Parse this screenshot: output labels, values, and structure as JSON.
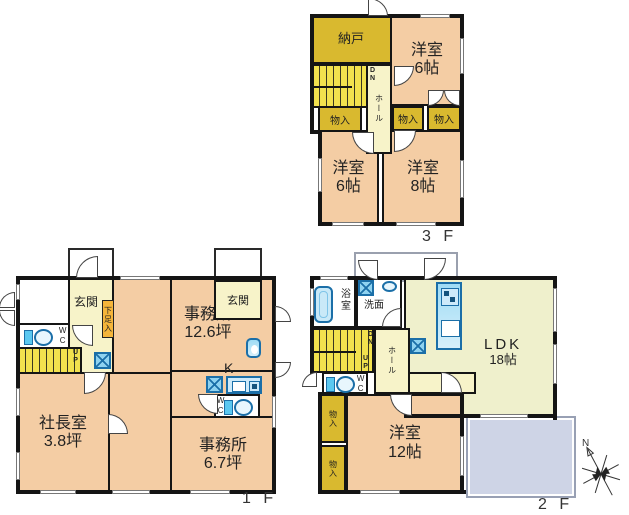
{
  "colors": {
    "wall": "#151515",
    "room_peach": "#f4cda4",
    "closet_dark_yellow": "#d9b92f",
    "stairs_yellow": "#f2e14e",
    "hall_pale_yellow": "#f7f3c9",
    "ldk_pale": "#eff0cc",
    "fixture_blue": "#1b6fa8",
    "fixture_blue_light": "#8ed2f0",
    "shoe_cabinet_orange": "#f5b53a",
    "balcony_gray_blue": "#ced4e6"
  },
  "f3": {
    "floor_label": "3 F",
    "nando": "納戸",
    "room_top_name": "洋室",
    "room_top_size": "6帖",
    "closets": [
      "物入",
      "物入",
      "物入"
    ],
    "room_left_name": "洋室",
    "room_left_size": "6帖",
    "room_right_name": "洋室",
    "room_right_size": "8帖",
    "hall": "ホール",
    "dn": "DN"
  },
  "f1": {
    "floor_label": "1 F",
    "entrance_left": "玄関",
    "entrance_right": "玄関",
    "shoe_cabinet": "下足入",
    "wc_left": "WC",
    "wc_right": "WC",
    "up": "UP",
    "office_large_name": "事務所",
    "office_large_size": "12.6坪",
    "kitchen": "K",
    "president_name": "社長室",
    "president_size": "3.8坪",
    "office_small_name": "事務所",
    "office_small_size": "6.7坪"
  },
  "f2": {
    "floor_label": "2 F",
    "bath": "浴室",
    "washroom": "洗面",
    "dn": "DN",
    "up": "UP",
    "hall": "ホール",
    "wc": "WC",
    "ldk_name": "LDK",
    "ldk_size": "18帖",
    "closets": [
      "物入",
      "物入"
    ],
    "bedroom_name": "洋室",
    "bedroom_size": "12帖"
  },
  "compass": {
    "north": "N"
  }
}
